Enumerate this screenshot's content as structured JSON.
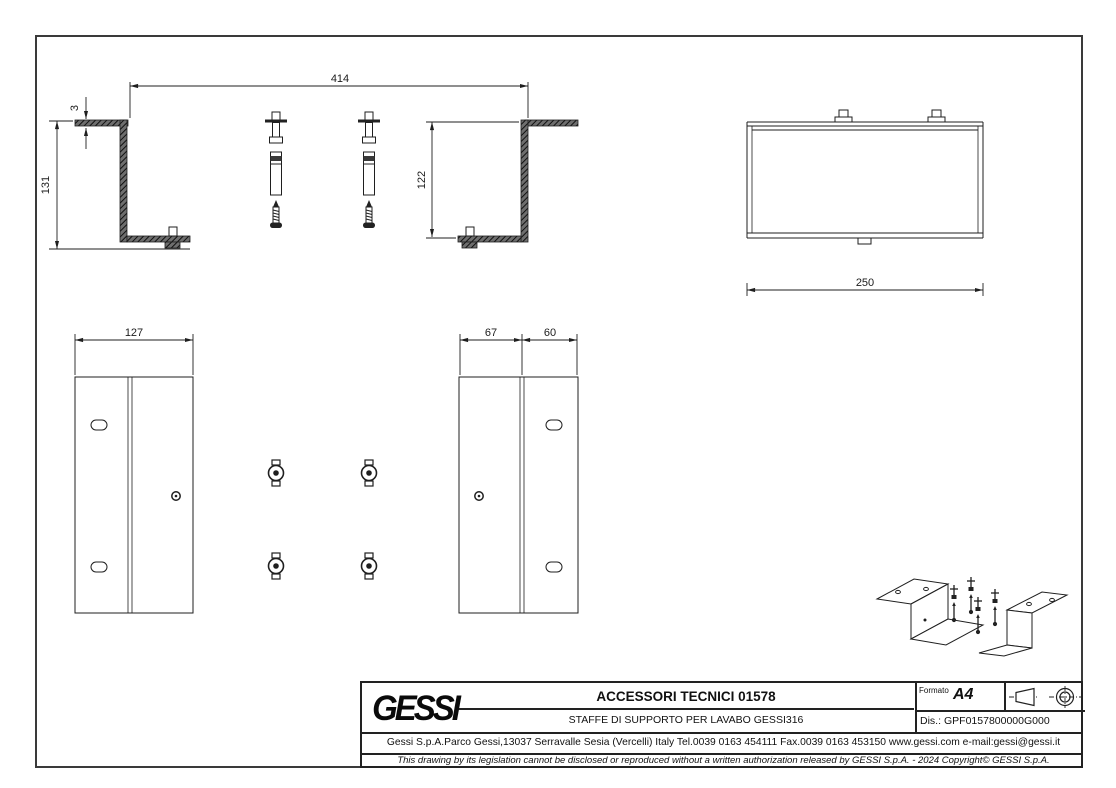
{
  "drawing": {
    "side_view": {
      "width": "414",
      "thickness": "3",
      "height_left": "131",
      "height_right": "122"
    },
    "front_view": {
      "width": "250"
    },
    "plan_view_left": {
      "width": "127"
    },
    "plan_view_right": {
      "width_left": "67",
      "width_right": "60"
    }
  },
  "title_block": {
    "logo_text": "GESSI",
    "title": "ACCESSORI TECNICI 01578",
    "subtitle": "STAFFE DI SUPPORTO PER LAVABO GESSI316",
    "format_label": "Formato",
    "format_value": "A4",
    "drawing_code_label": "Dis.:",
    "drawing_code": "GPF0157800000G000",
    "address_line": "Gessi S.p.A.Parco Gessi,13037 Serravalle Sesia (Vercelli) Italy Tel.0039 0163 454111 Fax.0039 0163 453150 www.gessi.com e-mail:gessi@gessi.it",
    "legal_line": "This drawing by its legislation cannot be disclosed or reproduced without a written authorization released by GESSI S.p.A. - 2024 Copyright© GESSI S.p.A.",
    "projection_symbol": "first-angle-projection"
  },
  "colors": {
    "line": "#1f1f1f",
    "background": "#ffffff"
  }
}
